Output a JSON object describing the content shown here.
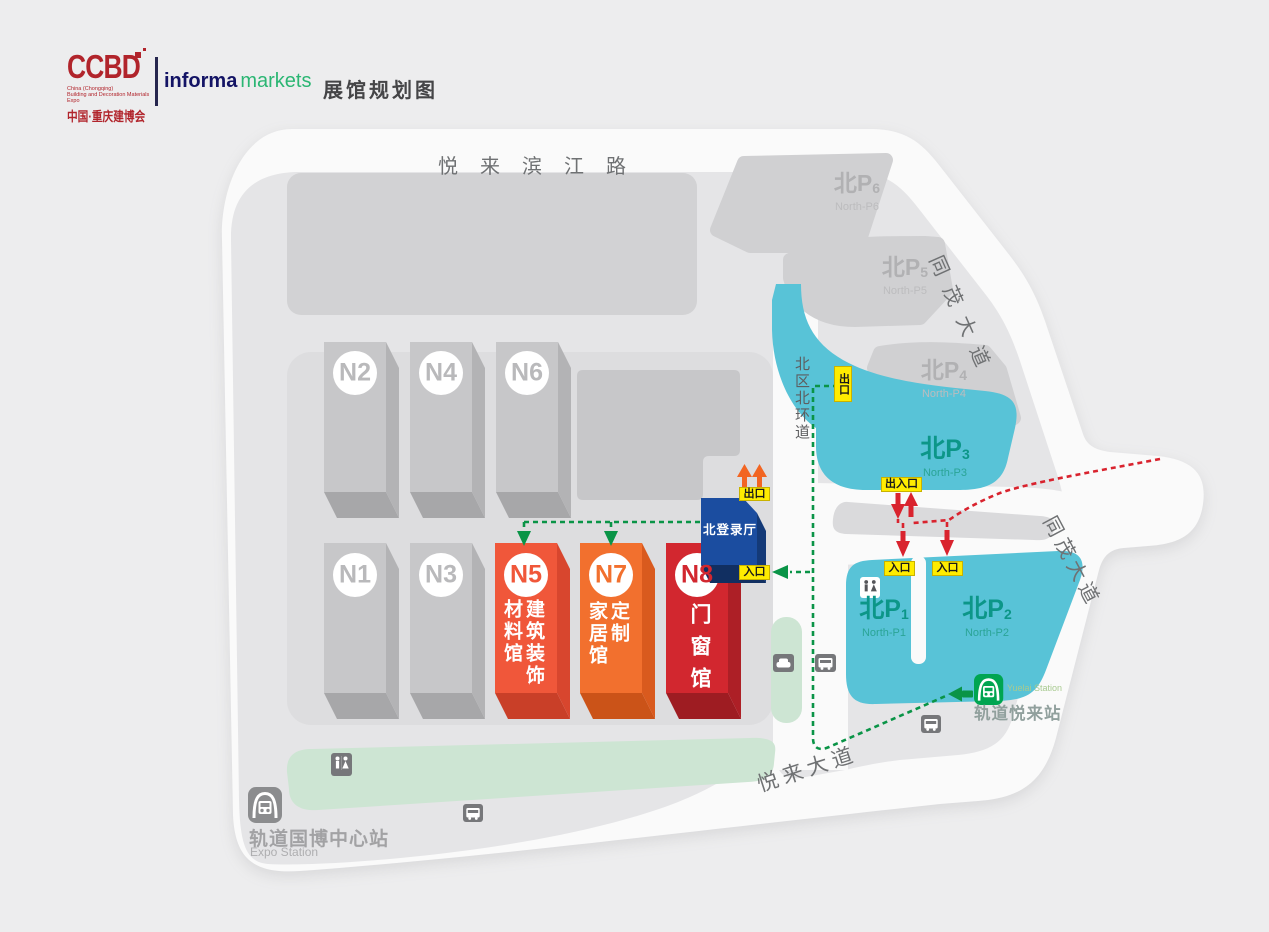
{
  "header": {
    "ccbd": "CCBD",
    "tagline_line1": "China (Chongqing)",
    "tagline_line2": "Building and Decoration Materials Expo",
    "ccbd_cn": "中国·重庆建博会",
    "informa": "informa",
    "markets": "markets",
    "title": "展馆规划图"
  },
  "roads": {
    "riverside": "悦来滨江路",
    "tongmao_upper": "同茂大道",
    "tongmao_lower": "同茂大道",
    "yuelai_avenue": "悦来大道",
    "north_ring": "北区北环道"
  },
  "halls": {
    "n1": "N1",
    "n2": "N2",
    "n3": "N3",
    "n4": "N4",
    "n6": "N6",
    "n5": {
      "id": "N5",
      "text": "建筑装饰\n材料馆"
    },
    "n7": {
      "id": "N7",
      "text": "定制\n家居馆"
    },
    "n8": {
      "id": "N8",
      "text": "门窗馆"
    },
    "registration_hall": "北登录厅"
  },
  "parking": {
    "p1": {
      "cn": "北P",
      "num": "1",
      "en": "North-P1"
    },
    "p2": {
      "cn": "北P",
      "num": "2",
      "en": "North-P2"
    },
    "p3": {
      "cn": "北P",
      "num": "3",
      "en": "North-P3"
    },
    "p4": {
      "cn": "北P",
      "num": "4",
      "en": "North-P4"
    },
    "p5": {
      "cn": "北P",
      "num": "5",
      "en": "North-P5"
    },
    "p6": {
      "cn": "北P",
      "num": "6",
      "en": "North-P6"
    }
  },
  "markers": {
    "exit": "出口",
    "entrance": "入口",
    "exit_entrance": "出入口"
  },
  "stations": {
    "expo": {
      "cn": "轨道国博中心站",
      "en": "Expo Station"
    },
    "yuelai": {
      "cn": "轨道悦来站",
      "en": "Yuelai Station"
    }
  },
  "colors": {
    "parking_cyan": "#58c3d7",
    "hall_n5": "#f0573a",
    "hall_n7": "#f2702e",
    "hall_n8": "#d2272f",
    "registration_blue": "#1b4da0",
    "route_green": "#0a9447",
    "route_red": "#d9232e",
    "marker_yellow": "#ffec00",
    "metro_green": "#00a551"
  }
}
